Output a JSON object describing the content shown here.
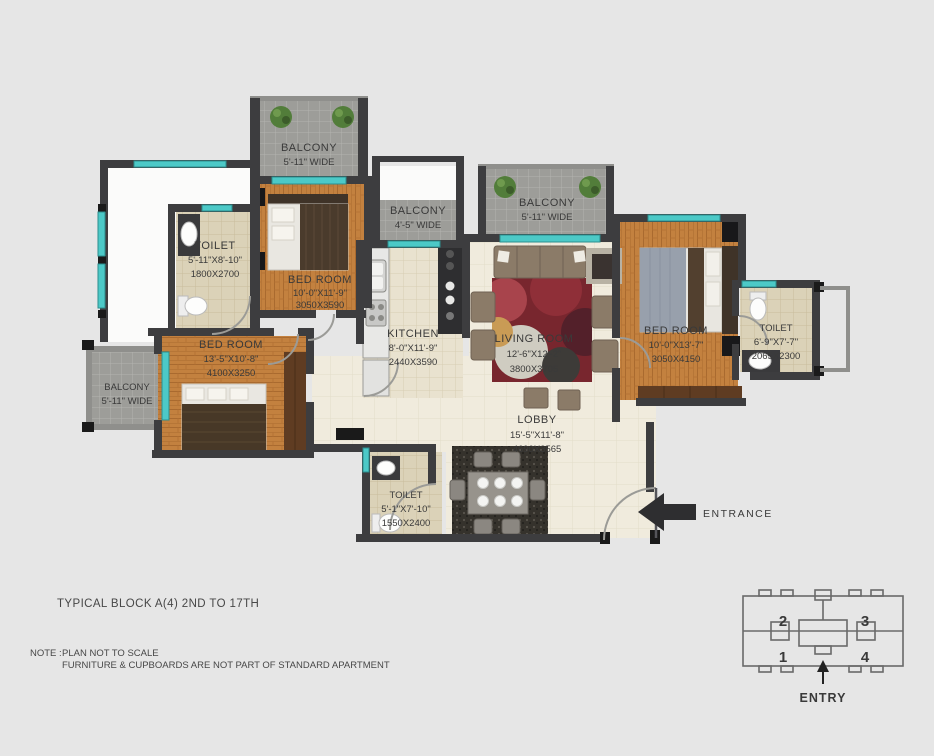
{
  "plan": {
    "rooms": {
      "balcony_top": {
        "name": "BALCONY",
        "width": "5'-11\" WIDE"
      },
      "toilet_top": {
        "name": "TOILET",
        "size_ft": "5'-11\"X8'-10\"",
        "size_mm": "1800X2700"
      },
      "bedroom_top": {
        "name": "BED ROOM",
        "size_ft": "10'-0\"X11'-9\"",
        "size_mm": "3050X3590"
      },
      "balcony_kitchen": {
        "name": "BALCONY",
        "width": "4'-5\" WIDE"
      },
      "balcony_living": {
        "name": "BALCONY",
        "width": "5'-11\" WIDE"
      },
      "balcony_left": {
        "name": "BALCONY",
        "width": "5'-11\" WIDE"
      },
      "bedroom_left": {
        "name": "BED ROOM",
        "size_ft": "13'-5\"X10'-8\"",
        "size_mm": "4100X3250"
      },
      "kitchen": {
        "name": "KITCHEN",
        "size_ft": "8'-0\"X11'-9\"",
        "size_mm": "2440X3590"
      },
      "living_room": {
        "name": "LIVING ROOM",
        "size_ft": "12'-6\"X12'-2\"",
        "size_mm": "3800X3705"
      },
      "bedroom_right": {
        "name": "BED ROOM",
        "size_ft": "10'-0\"X13'-7\"",
        "size_mm": "3050X4150"
      },
      "toilet_right": {
        "name": "TOILET",
        "size_ft": "6'-9\"X7'-7\"",
        "size_mm": "2065X2300"
      },
      "lobby": {
        "name": "LOBBY",
        "size_ft": "15'-5\"X11'-8\"",
        "size_mm": "4690X3565"
      },
      "toilet_bottom": {
        "name": "TOILET",
        "size_ft": "5'-1\"X7'-10\"",
        "size_mm": "1550X2400"
      }
    },
    "entrance_label": "ENTRANCE"
  },
  "footer": {
    "block_title": "TYPICAL BLOCK A(4) 2ND TO 17TH",
    "note_label": "NOTE :",
    "note_line1": "PLAN NOT TO SCALE",
    "note_line2": "FURNITURE & CUPBOARDS ARE NOT PART OF STANDARD APARTMENT"
  },
  "key_plan": {
    "unit_top_left": "2",
    "unit_top_right": "3",
    "unit_bottom_left": "1",
    "unit_bottom_right": "4",
    "entry_label": "ENTRY"
  },
  "colors": {
    "background": "#e6e6e6",
    "wall": "#3d3d3f",
    "window_teal": "#4cc9c7",
    "wood_floor": "#c3813f",
    "balcony_tile": "#9d9d99",
    "toilet_tile": "#dbd2b8",
    "cream_tile": "#f0ebdd"
  }
}
